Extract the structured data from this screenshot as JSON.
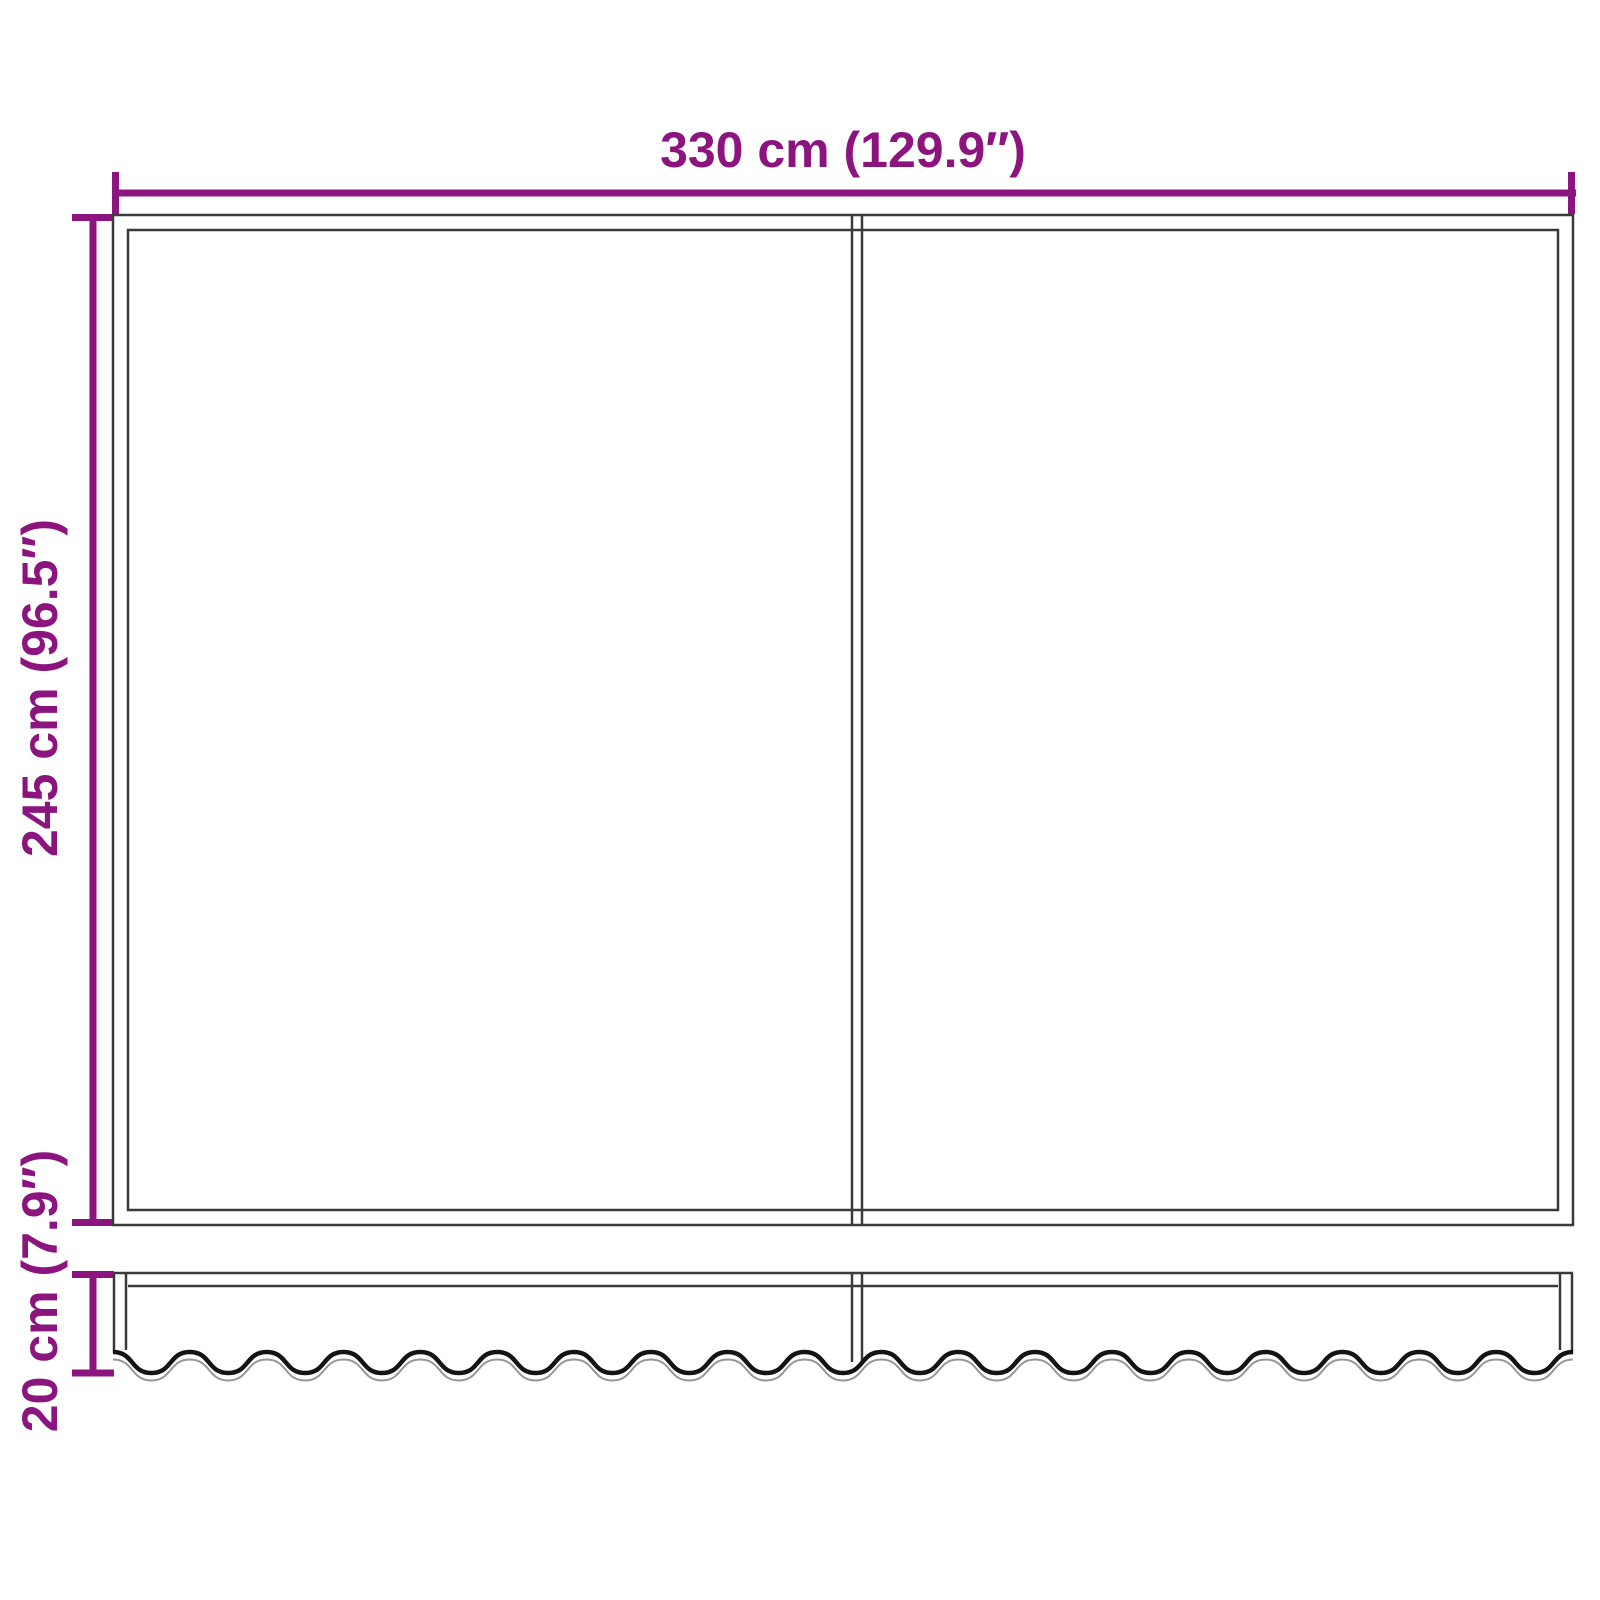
{
  "colors": {
    "accent": "#8B147E",
    "outline": "#3A3A3A",
    "wave": "#141414",
    "wave_echo": "#969696",
    "background": "#FFFFFF"
  },
  "dimensions": {
    "width": {
      "label": "330 cm (129.9″)"
    },
    "height": {
      "label": "245 cm (96.5″)"
    },
    "valance_height": {
      "label": "20 cm (7.9″)"
    }
  }
}
